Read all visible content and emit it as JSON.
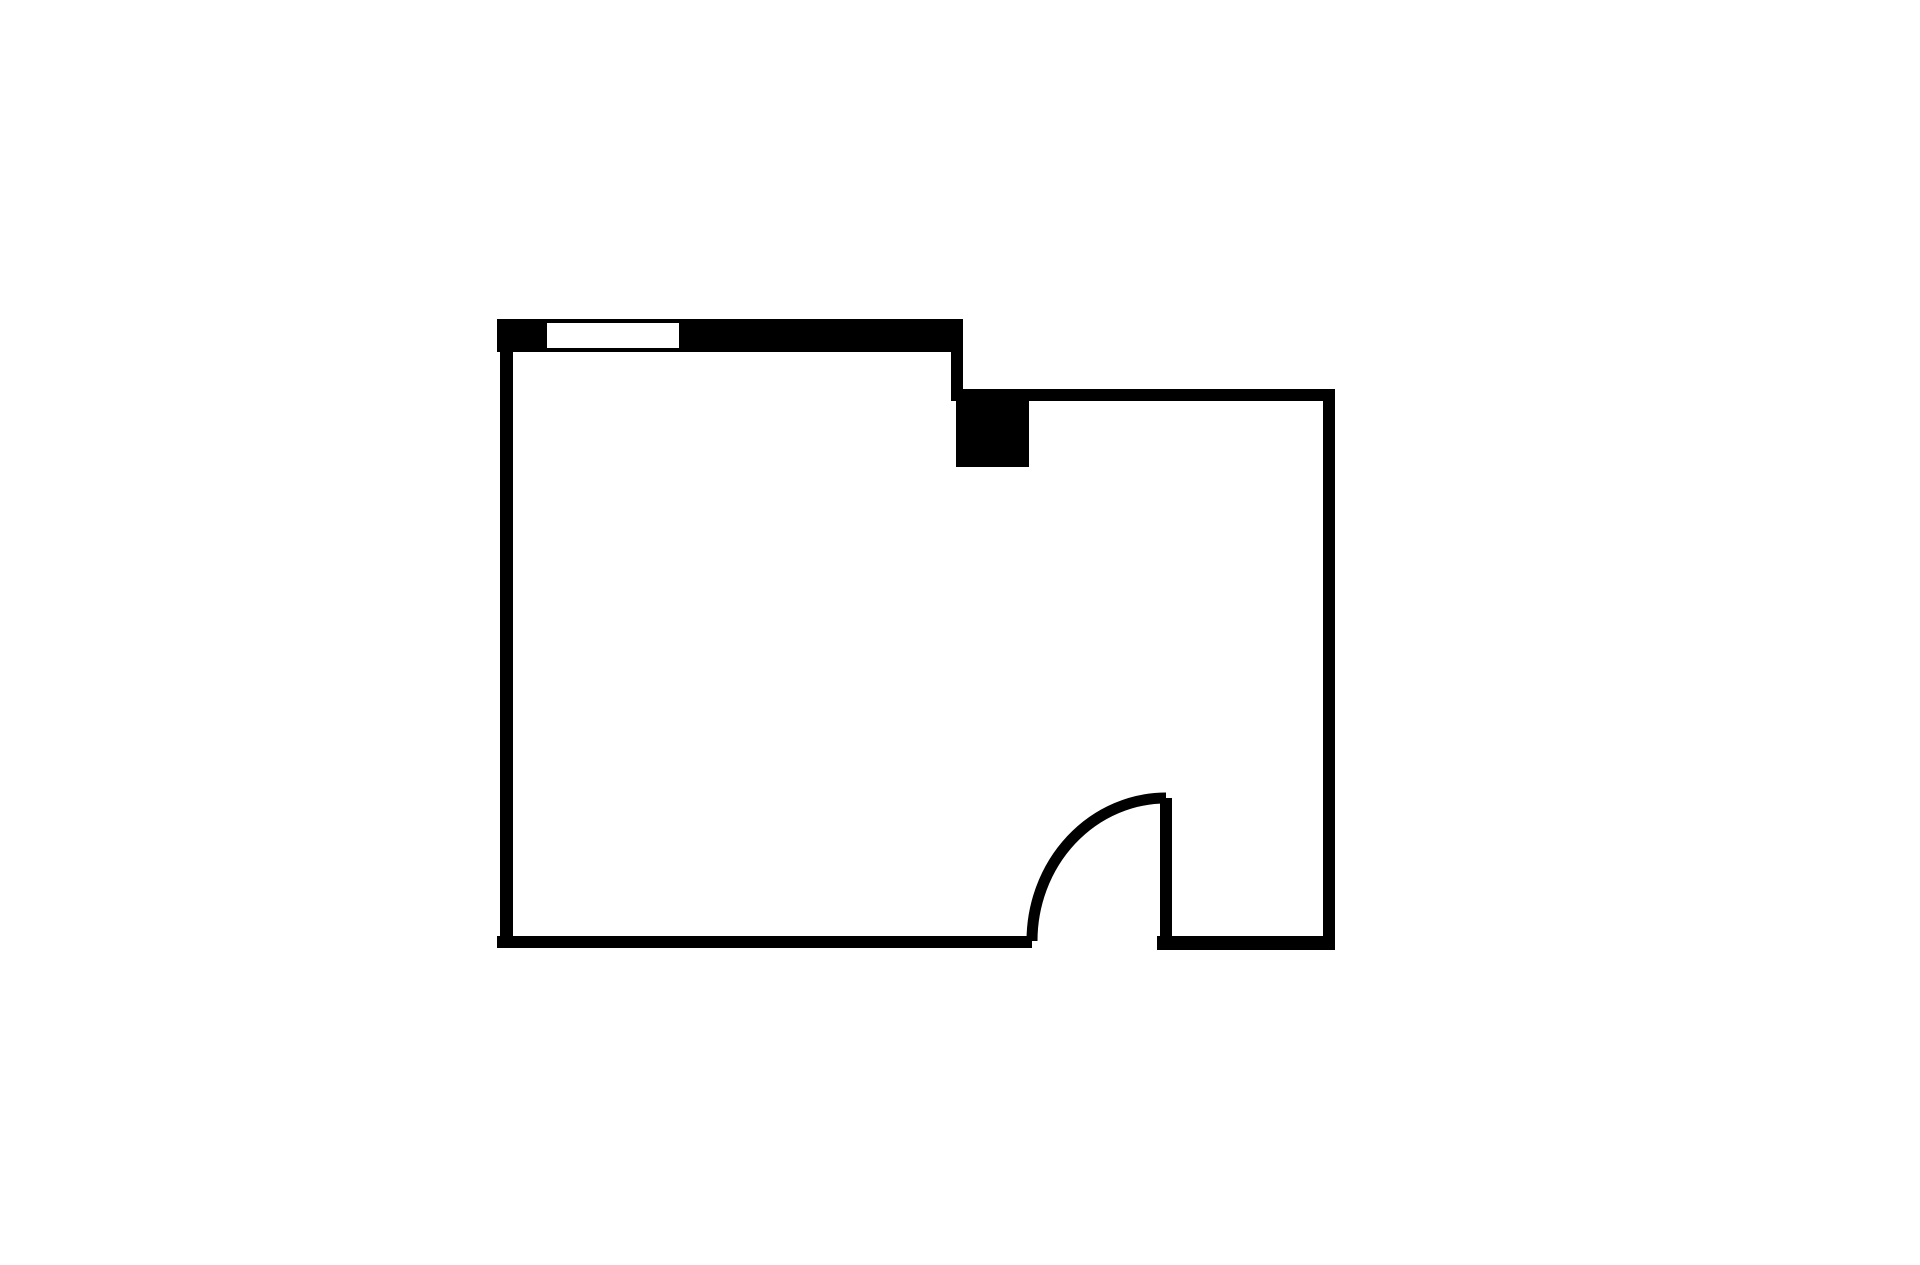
{
  "page": {
    "background": "#ffffff"
  },
  "floorplan": {
    "canvas": {
      "width": 1920,
      "height": 1265
    },
    "colors": {
      "wall": "#000000",
      "floor": "#ffffff"
    },
    "elements": [
      {
        "name": "top-wall-thick",
        "type": "rect",
        "x": 497,
        "y": 319,
        "w": 466,
        "h": 33,
        "fill": "wall"
      },
      {
        "name": "window-opening",
        "type": "rect",
        "x": 547,
        "y": 323,
        "w": 132,
        "h": 25,
        "fill": "floor"
      },
      {
        "name": "step-wall",
        "type": "rect",
        "x": 951,
        "y": 352,
        "w": 12,
        "h": 49,
        "fill": "wall"
      },
      {
        "name": "right-top-wall",
        "type": "rect",
        "x": 956,
        "y": 389,
        "w": 379,
        "h": 12,
        "fill": "wall"
      },
      {
        "name": "column-block",
        "type": "rect",
        "x": 956,
        "y": 390,
        "w": 73,
        "h": 77,
        "fill": "wall"
      },
      {
        "name": "right-wall",
        "type": "rect",
        "x": 1323,
        "y": 389,
        "w": 12,
        "h": 561,
        "fill": "wall"
      },
      {
        "name": "bottom-right-wall",
        "type": "rect",
        "x": 1157,
        "y": 936,
        "w": 178,
        "h": 14,
        "fill": "wall"
      },
      {
        "name": "bottom-left-wall",
        "type": "rect",
        "x": 497,
        "y": 936,
        "w": 535,
        "h": 12,
        "fill": "wall"
      },
      {
        "name": "left-wall",
        "type": "rect",
        "x": 500,
        "y": 352,
        "w": 13,
        "h": 596,
        "fill": "wall"
      },
      {
        "name": "door-leaf",
        "type": "rect",
        "x": 1160,
        "y": 798,
        "w": 12,
        "h": 152,
        "fill": "wall"
      },
      {
        "name": "door-swing-arc",
        "type": "path",
        "d": "M 1032 941 A 134 143 0 0 1 1166 798",
        "stroke": "wall",
        "strokeWidth": 11
      }
    ]
  }
}
